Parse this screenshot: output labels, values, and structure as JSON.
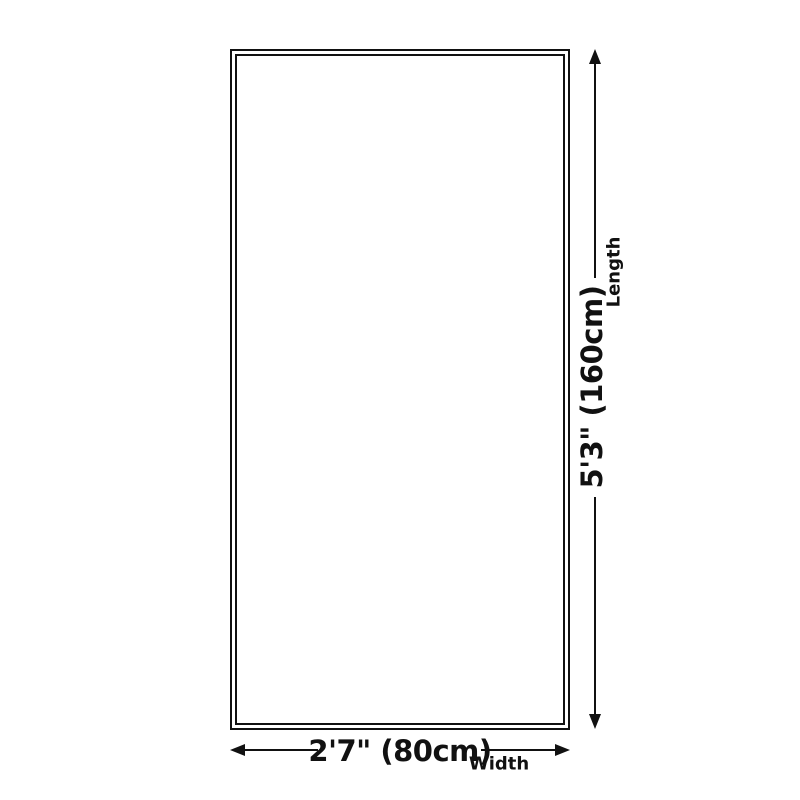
{
  "diagram": {
    "background_color": "#ffffff",
    "line_color": "#111111",
    "shape": "rectangle-double-border",
    "length_dimension": {
      "value": "5'3\" (160cm)",
      "label": "Length"
    },
    "width_dimension": {
      "value": "2'7\" (80cm)",
      "label": "Width"
    }
  }
}
